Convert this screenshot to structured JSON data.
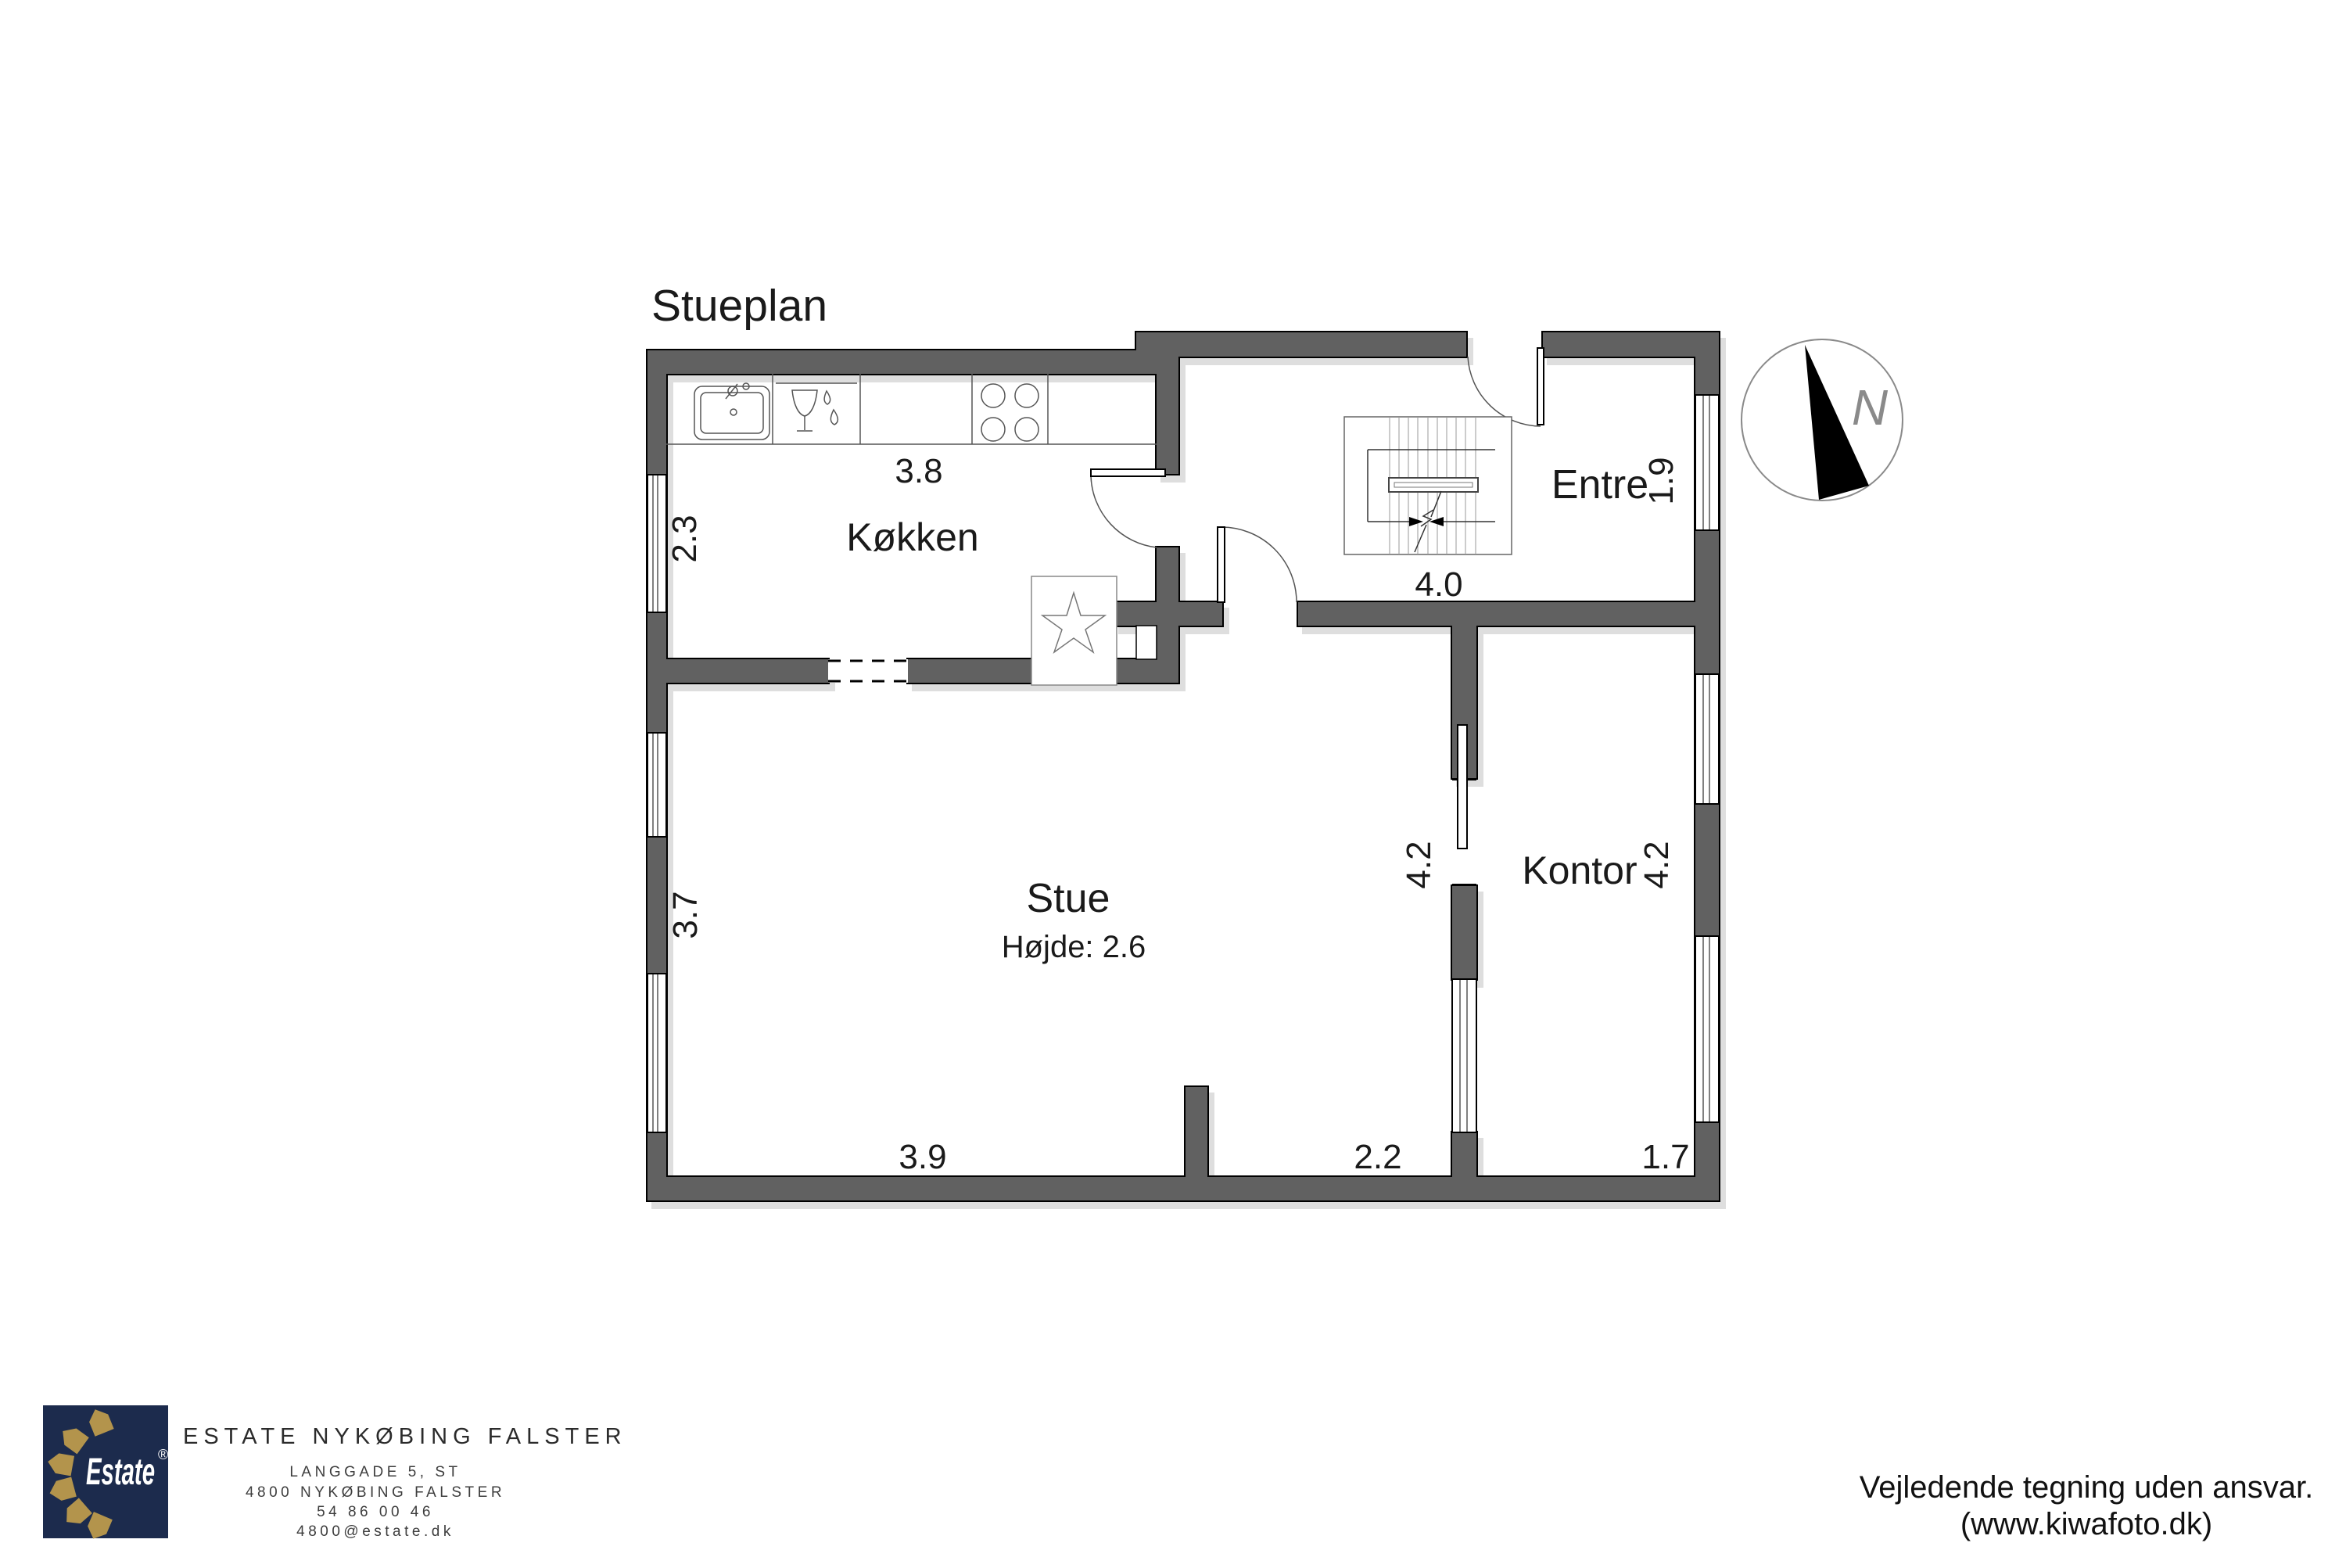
{
  "title": "Stueplan",
  "compass": {
    "north_label": "N"
  },
  "rooms": {
    "koekken": {
      "name": "Køkken",
      "width": "3.8",
      "depth": "2.3"
    },
    "entre": {
      "name": "Entre",
      "width": "4.0",
      "depth": "1.9"
    },
    "stue": {
      "name": "Stue",
      "ceiling": "Højde: 2.6",
      "depth": "3.7",
      "east_depth": "4.2",
      "south_west": "3.9",
      "south_east": "2.2"
    },
    "kontor": {
      "name": "Kontor",
      "depth": "4.2",
      "south": "1.7"
    }
  },
  "footer": {
    "logo_text": "Estate",
    "logo_reg": "®",
    "agency": "ESTATE NYKØBING FALSTER",
    "address_line1": "LANGGADE 5, ST",
    "address_line2": "4800 NYKØBING FALSTER",
    "phone": "54 86 00 46",
    "email": "4800@estate.dk",
    "disclaimer_line1": "Vejledende tegning uden ansvar.",
    "disclaimer_line2": "(www.kiwafoto.dk)",
    "brand_navy": "#1c2b4d",
    "brand_gold": "#b3944c"
  }
}
